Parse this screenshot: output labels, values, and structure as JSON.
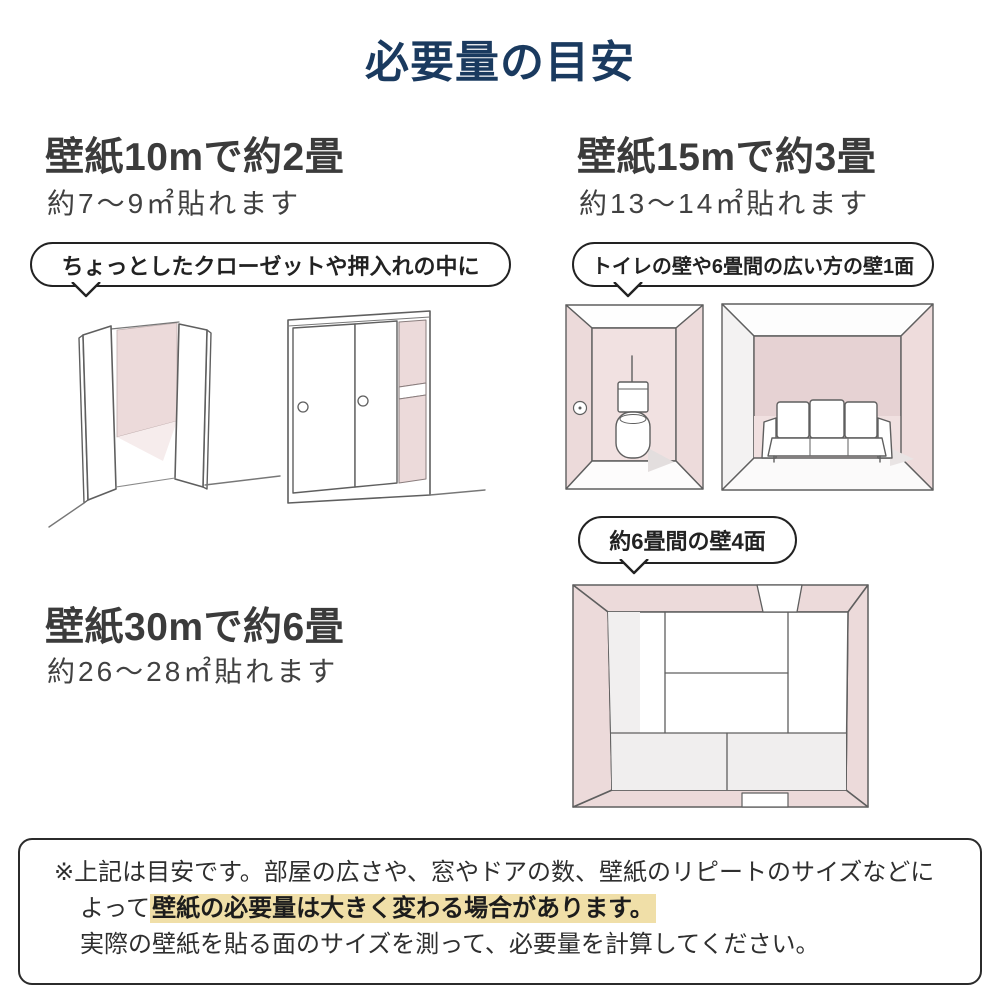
{
  "title": "必要量の目安",
  "sections": [
    {
      "heading": "壁紙10mで約2畳",
      "subheading": "約7～9㎡貼れます",
      "bubble": "ちょっとしたクローゼットや押入れの中に"
    },
    {
      "heading": "壁紙15mで約3畳",
      "subheading": "約13～14㎡貼れます",
      "bubble": "トイレの壁や6畳間の広い方の壁1面",
      "bubble2": "約6畳間の壁4面"
    },
    {
      "heading": "壁紙30mで約6畳",
      "subheading": "約26～28㎡貼れます"
    }
  ],
  "note": {
    "line1": "※上記は目安です。部屋の広さや、窓やドアの数、壁紙のリピートのサイズなどに",
    "line2_prefix": "よって",
    "line2_highlight": "壁紙の必要量は大きく変わる場合があります。",
    "line3": "実際の壁紙を貼る面のサイズを測って、必要量を計算してください。"
  },
  "colors": {
    "title_navy": "#1a3a5f",
    "text_dark": "#3b3b3b",
    "wallpaper_pink": "#ecdada",
    "wallpaper_pink_dark": "#e6d2d3",
    "wallpaper_pink_pale": "#f6ecec",
    "highlight_yellow": "#f0dfa8",
    "sketch_line": "#5f5f5f"
  }
}
